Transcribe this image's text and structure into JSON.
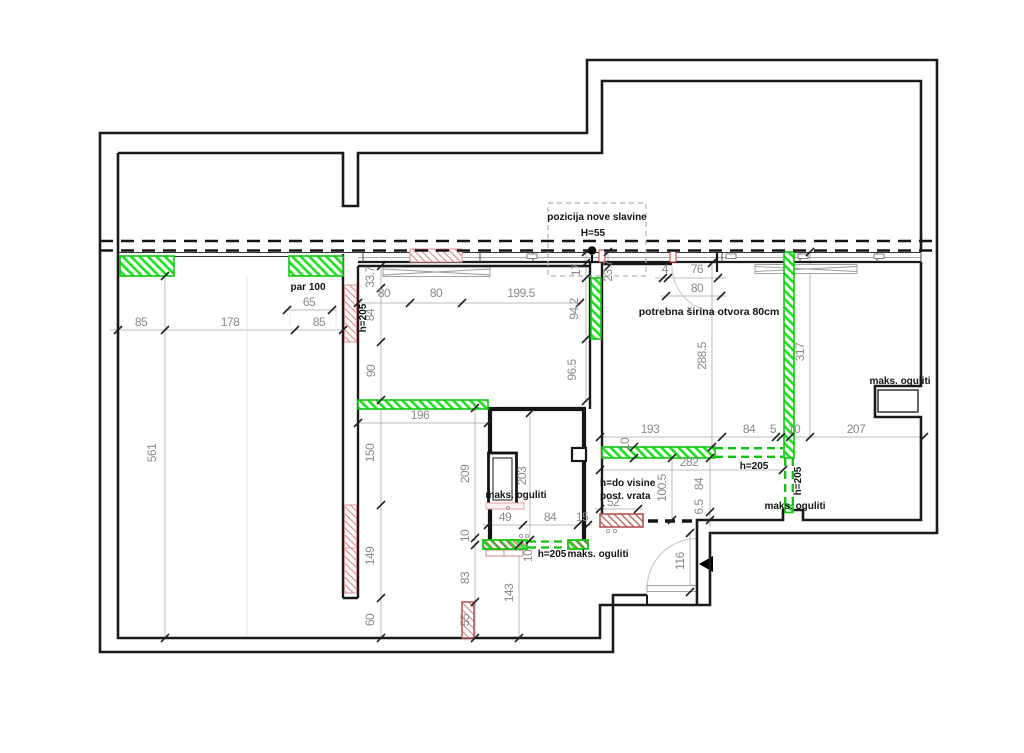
{
  "drawing": {
    "title": "floor plan – adaptation drawing",
    "colors": {
      "wall_black": "#1a1a1a",
      "new_wall_green": "#1ae51a",
      "demolition_pink": "#dc9090",
      "demolition_red": "#b04848",
      "dim_gray": "#8a8a8a"
    },
    "dims": [
      {
        "t": "85",
        "x": 141,
        "y": 326
      },
      {
        "t": "178",
        "x": 230,
        "y": 326
      },
      {
        "t": "65",
        "x": 309,
        "y": 306
      },
      {
        "t": "85",
        "x": 319,
        "y": 326
      },
      {
        "t": "561",
        "x": 156,
        "y": 453,
        "r": -90
      },
      {
        "t": "33.7",
        "x": 374,
        "y": 277,
        "r": -90
      },
      {
        "t": "84",
        "x": 374,
        "y": 315,
        "r": -90
      },
      {
        "t": "90",
        "x": 375,
        "y": 371,
        "r": -90
      },
      {
        "t": "80",
        "x": 384,
        "y": 297
      },
      {
        "t": "80",
        "x": 436,
        "y": 297
      },
      {
        "t": "199.5",
        "x": 521,
        "y": 297
      },
      {
        "t": "17",
        "x": 580,
        "y": 270,
        "r": -90
      },
      {
        "t": "94.2",
        "x": 578,
        "y": 309,
        "r": -90
      },
      {
        "t": "96.5",
        "x": 576,
        "y": 370,
        "r": -90
      },
      {
        "t": "23.7",
        "x": 612,
        "y": 271,
        "r": -90
      },
      {
        "t": "4",
        "x": 665,
        "y": 273
      },
      {
        "t": "76",
        "x": 697,
        "y": 273
      },
      {
        "t": "80",
        "x": 697,
        "y": 292
      },
      {
        "t": "288.5",
        "x": 706,
        "y": 356,
        "r": -90
      },
      {
        "t": "317",
        "x": 804,
        "y": 352,
        "r": -90
      },
      {
        "t": "193",
        "x": 650,
        "y": 433
      },
      {
        "t": "84",
        "x": 749,
        "y": 433
      },
      {
        "t": "5",
        "x": 773,
        "y": 433
      },
      {
        "t": "10",
        "x": 794,
        "y": 433
      },
      {
        "t": "207",
        "x": 856,
        "y": 433
      },
      {
        "t": "10",
        "x": 629,
        "y": 444,
        "r": -90
      },
      {
        "t": "282",
        "x": 689,
        "y": 466
      },
      {
        "t": "100.5",
        "x": 666,
        "y": 488,
        "r": -90
      },
      {
        "t": "84",
        "x": 703,
        "y": 484,
        "r": -90
      },
      {
        "t": "6.5",
        "x": 703,
        "y": 507,
        "r": -90
      },
      {
        "t": "52",
        "x": 613,
        "y": 506
      },
      {
        "t": "116",
        "x": 684,
        "y": 561,
        "r": -90
      },
      {
        "t": "196",
        "x": 420,
        "y": 419
      },
      {
        "t": "150",
        "x": 374,
        "y": 453,
        "r": -90
      },
      {
        "t": "149",
        "x": 374,
        "y": 556,
        "r": -90
      },
      {
        "t": "60",
        "x": 374,
        "y": 620,
        "r": -90
      },
      {
        "t": "209",
        "x": 469,
        "y": 474,
        "r": -90
      },
      {
        "t": "10",
        "x": 469,
        "y": 536,
        "r": -90
      },
      {
        "t": "83",
        "x": 469,
        "y": 578,
        "r": -90
      },
      {
        "t": "55",
        "x": 469,
        "y": 620,
        "r": -90
      },
      {
        "t": "203",
        "x": 526,
        "y": 476,
        "r": -90
      },
      {
        "t": "10",
        "x": 532,
        "y": 556,
        "r": -90
      },
      {
        "t": "143",
        "x": 513,
        "y": 593,
        "r": -90
      },
      {
        "t": "49",
        "x": 505,
        "y": 521
      },
      {
        "t": "84",
        "x": 550,
        "y": 521
      },
      {
        "t": "15",
        "x": 582,
        "y": 521
      }
    ],
    "labels": [
      {
        "t": "pozicija nove slavine",
        "x": 597,
        "y": 220,
        "n": "label-pozicija-nove-slavine"
      },
      {
        "t": "H=55",
        "x": 593,
        "y": 236,
        "n": "label-h55"
      },
      {
        "t": "par 100",
        "x": 308,
        "y": 290,
        "n": "label-par-100"
      },
      {
        "t": "h=205",
        "x": 366,
        "y": 318,
        "r": -90,
        "n": "label-h205-left-wall"
      },
      {
        "t": "potrebna širina otvora 80cm",
        "x": 709,
        "y": 315,
        "n": "label-potrebna-sirina-otvora",
        "big": true
      },
      {
        "t": "maks. oguliti",
        "x": 900,
        "y": 384,
        "n": "label-maks-oguliti-niche"
      },
      {
        "t": "h=205",
        "x": 754,
        "y": 469,
        "n": "label-h205-corridor"
      },
      {
        "t": "h=205",
        "x": 801,
        "y": 481,
        "r": -90,
        "n": "label-h205-column"
      },
      {
        "t": "maks. oguliti",
        "x": 795,
        "y": 509,
        "n": "label-maks-oguliti-corridor"
      },
      {
        "t": "h=do visine",
        "x": 600,
        "y": 486,
        "a": "start",
        "n": "label-h-do-visine"
      },
      {
        "t": "post. vrata",
        "x": 600,
        "y": 499,
        "a": "start",
        "n": "label-post-vrata"
      },
      {
        "t": "maks. oguliti",
        "x": 516,
        "y": 498,
        "n": "label-maks-oguliti-bathroom"
      },
      {
        "t": "h=205",
        "x": 552,
        "y": 557,
        "n": "label-h205-bathroom"
      },
      {
        "t": "maks. oguliti",
        "x": 598,
        "y": 557,
        "n": "label-maks-oguliti-bathroom2"
      }
    ]
  }
}
